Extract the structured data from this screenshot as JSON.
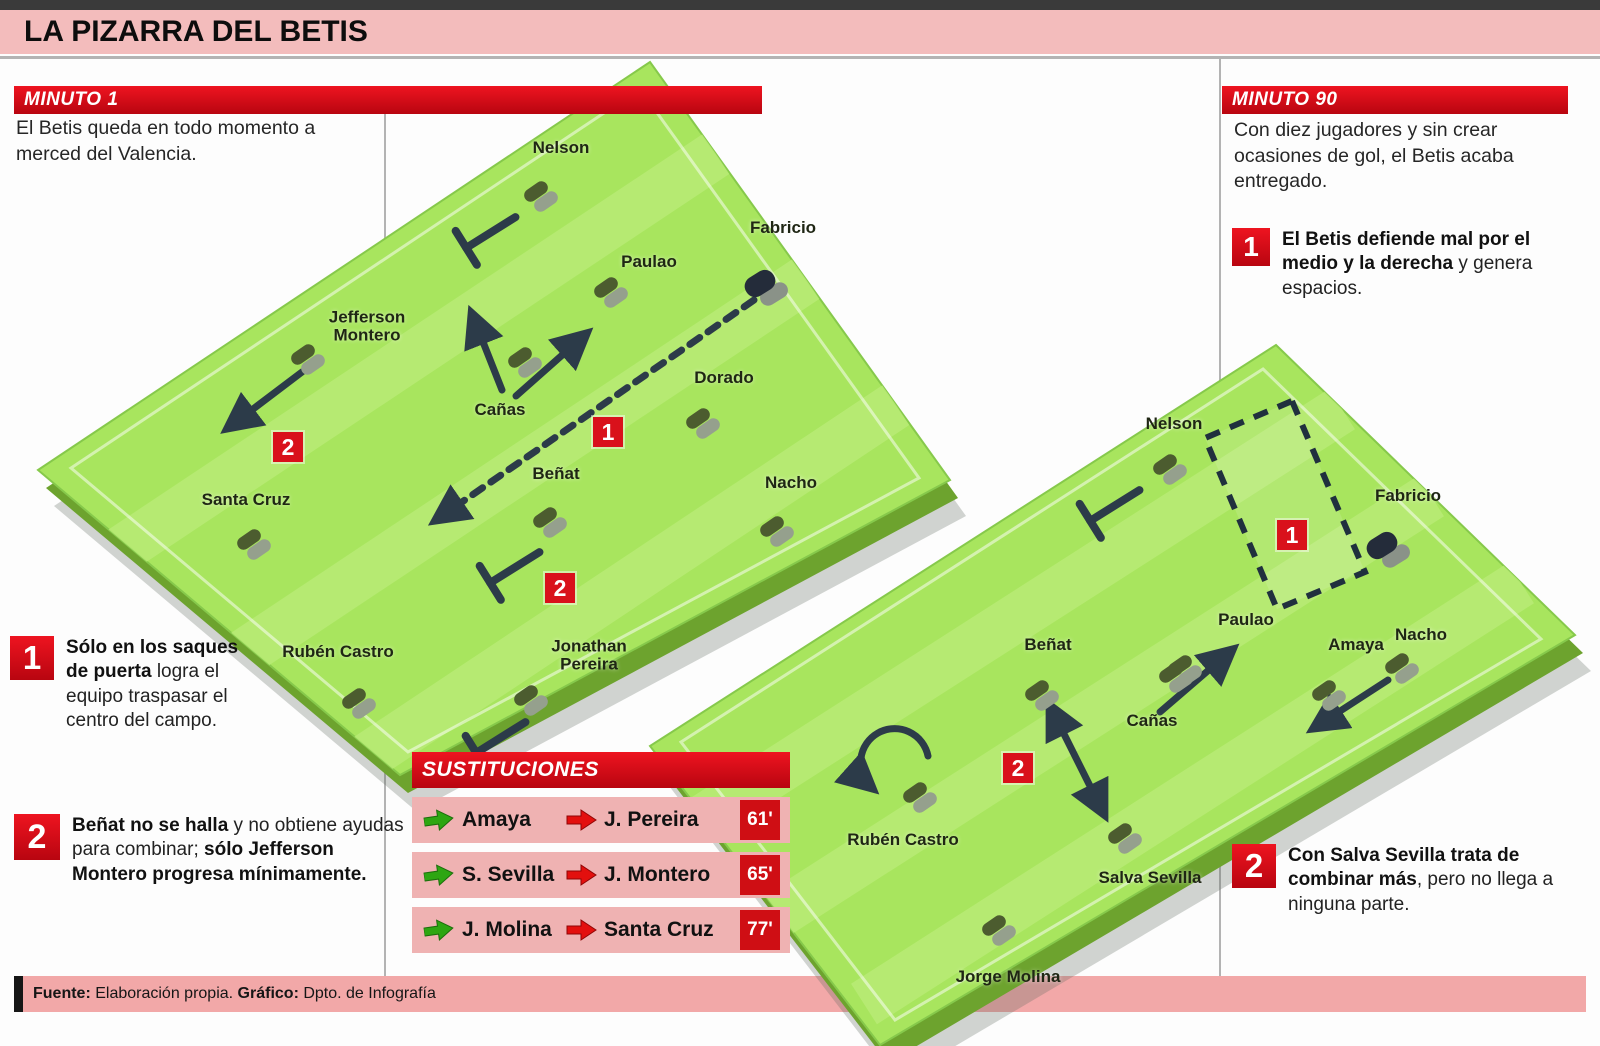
{
  "title": "LA PIZARRA DEL BETIS",
  "colors": {
    "accent_red": "#d40d12",
    "band_pink": "#f3bcbc",
    "row_pink": "#efb2b2",
    "pitch_green": "#a8e55e",
    "pitch_stripe": "#b9ec76",
    "pitch_side": "#6da32e",
    "arrow_dark": "#2c3b49",
    "in_arrow_green": "#2ea612",
    "out_arrow_red": "#e3100e"
  },
  "minute1": {
    "header": "MINUTO 1",
    "intro": "El Betis queda en todo momento a merced del Valencia.",
    "notes": [
      {
        "num": "1",
        "parts": [
          {
            "t": "Sólo en los saques de puerta ",
            "b": true
          },
          {
            "t": "logra el equipo traspasar el centro del campo.",
            "b": false
          }
        ]
      },
      {
        "num": "2",
        "parts": [
          {
            "t": "Beñat no se halla ",
            "b": true
          },
          {
            "t": "y no obtiene ayudas para combinar; ",
            "b": false
          },
          {
            "t": "sólo Jefferson Montero progresa mínimamente.",
            "b": true
          }
        ]
      }
    ],
    "players": [
      {
        "name": "Nelson",
        "x": 539,
        "y": 196,
        "lx": 561,
        "ly": 148
      },
      {
        "name": "Fabricio",
        "x": 763,
        "y": 288,
        "lx": 783,
        "ly": 228,
        "gk": true
      },
      {
        "name": "Paulao",
        "x": 609,
        "y": 292,
        "lx": 649,
        "ly": 262
      },
      {
        "name": "Jefferson\nMontero",
        "x": 306,
        "y": 359,
        "lx": 367,
        "ly": 326
      },
      {
        "name": "Cañas",
        "x": 523,
        "y": 362,
        "lx": 500,
        "ly": 410
      },
      {
        "name": "Dorado",
        "x": 701,
        "y": 423,
        "lx": 724,
        "ly": 378
      },
      {
        "name": "Santa Cruz",
        "x": 252,
        "y": 544,
        "lx": 246,
        "ly": 500
      },
      {
        "name": "Beñat",
        "x": 548,
        "y": 522,
        "lx": 556,
        "ly": 474
      },
      {
        "name": "Nacho",
        "x": 775,
        "y": 531,
        "lx": 791,
        "ly": 483
      },
      {
        "name": "Rubén Castro",
        "x": 357,
        "y": 703,
        "lx": 338,
        "ly": 652
      },
      {
        "name": "Jonathan\nPereira",
        "x": 529,
        "y": 700,
        "lx": 589,
        "ly": 655
      }
    ],
    "badges": [
      {
        "num": "2",
        "x": 288,
        "y": 447
      },
      {
        "num": "1",
        "x": 608,
        "y": 432
      },
      {
        "num": "2",
        "x": 560,
        "y": 588
      }
    ]
  },
  "minute90": {
    "header": "MINUTO 90",
    "intro": "Con diez jugadores y sin crear ocasiones de gol, el Betis acaba entregado.",
    "notes": [
      {
        "num": "1",
        "parts": [
          {
            "t": "El Betis defiende mal por el medio y la derecha ",
            "b": true
          },
          {
            "t": "y genera espacios.",
            "b": false
          }
        ]
      },
      {
        "num": "2",
        "parts": [
          {
            "t": "Con Salva Sevilla trata de combinar más",
            "b": true
          },
          {
            "t": ", pero no llega a ninguna parte.",
            "b": false
          }
        ]
      }
    ],
    "players": [
      {
        "name": "Nelson",
        "x": 1168,
        "y": 469,
        "lx": 1174,
        "ly": 424
      },
      {
        "name": "Fabricio",
        "x": 1385,
        "y": 550,
        "lx": 1408,
        "ly": 496,
        "gk": true
      },
      {
        "name": "Paulao",
        "x": 1183,
        "y": 670,
        "lx": 1246,
        "ly": 620
      },
      {
        "name": "Amaya",
        "x": 1327,
        "y": 695,
        "lx": 1356,
        "ly": 645
      },
      {
        "name": "Cañas",
        "x": 1174,
        "y": 677,
        "lx": 1152,
        "ly": 721
      },
      {
        "name": "Beñat",
        "x": 1040,
        "y": 695,
        "lx": 1048,
        "ly": 645
      },
      {
        "name": "Nacho",
        "x": 1400,
        "y": 668,
        "lx": 1421,
        "ly": 635
      },
      {
        "name": "Salva Sevilla",
        "x": 1123,
        "y": 838,
        "lx": 1150,
        "ly": 878
      },
      {
        "name": "Rubén Castro",
        "x": 918,
        "y": 797,
        "lx": 903,
        "ly": 840
      },
      {
        "name": "Jorge Molina",
        "x": 997,
        "y": 930,
        "lx": 1008,
        "ly": 977
      }
    ],
    "badges": [
      {
        "num": "1",
        "x": 1292,
        "y": 535
      },
      {
        "num": "2",
        "x": 1018,
        "y": 768
      }
    ]
  },
  "substitutions": {
    "header": "SUSTITUCIONES",
    "rows": [
      {
        "in": "Amaya",
        "out": "J. Pereira",
        "minute": "61'"
      },
      {
        "in": "S. Sevilla",
        "out": "J. Montero",
        "minute": "65'"
      },
      {
        "in": "J. Molina",
        "out": "Santa Cruz",
        "minute": "77'"
      }
    ]
  },
  "footer": {
    "source_label": "Fuente:",
    "source": " Elaboración propia. ",
    "graphic_label": "Gráfico:",
    "graphic": " Dpto. de Infografía"
  }
}
